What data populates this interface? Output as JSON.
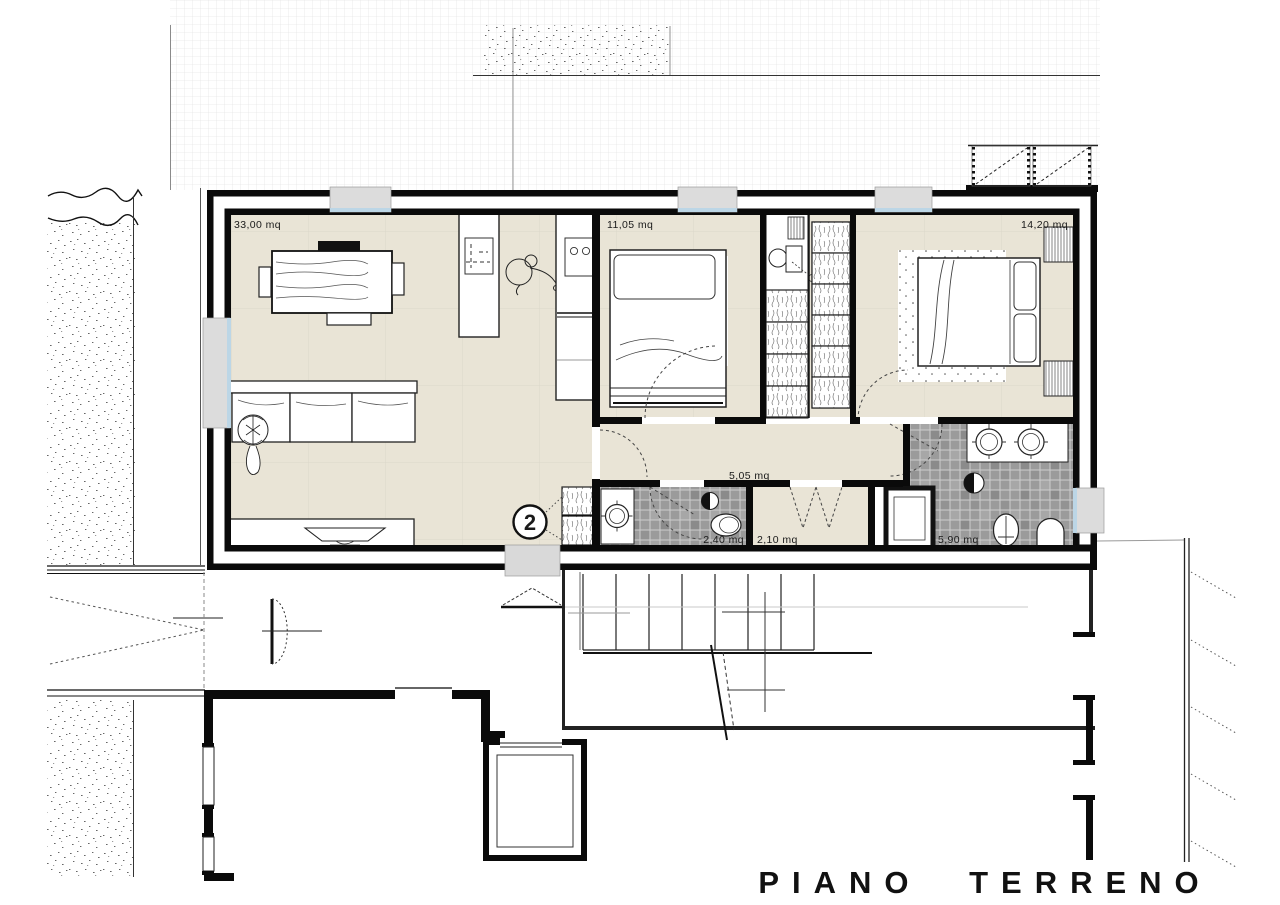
{
  "drawing": {
    "title": "PIANO TERRENO",
    "unit_badge": "2",
    "rooms": {
      "living": {
        "name": "soggiorno",
        "area": "33,00 mq"
      },
      "bedroom1": {
        "name": "camera 1",
        "area": "11,05 mq"
      },
      "bedroom2": {
        "name": "camera 2",
        "area": "14,20 mq"
      },
      "hallway": {
        "name": "disimpegno",
        "area": "5,05 mq"
      },
      "bath1": {
        "name": "bagno 1",
        "area": "2,40 mq"
      },
      "closet": {
        "name": "ripostiglio",
        "area": "2,10 mq"
      },
      "bath2": {
        "name": "bagno 2",
        "area": "5,90 mq"
      }
    },
    "colors": {
      "wall": "#0a0a0a",
      "floor": "#e9e4d6",
      "tile": "#9b9b9b",
      "window_fill": "#dcdcdc",
      "glass": "#bcd6e6"
    }
  }
}
